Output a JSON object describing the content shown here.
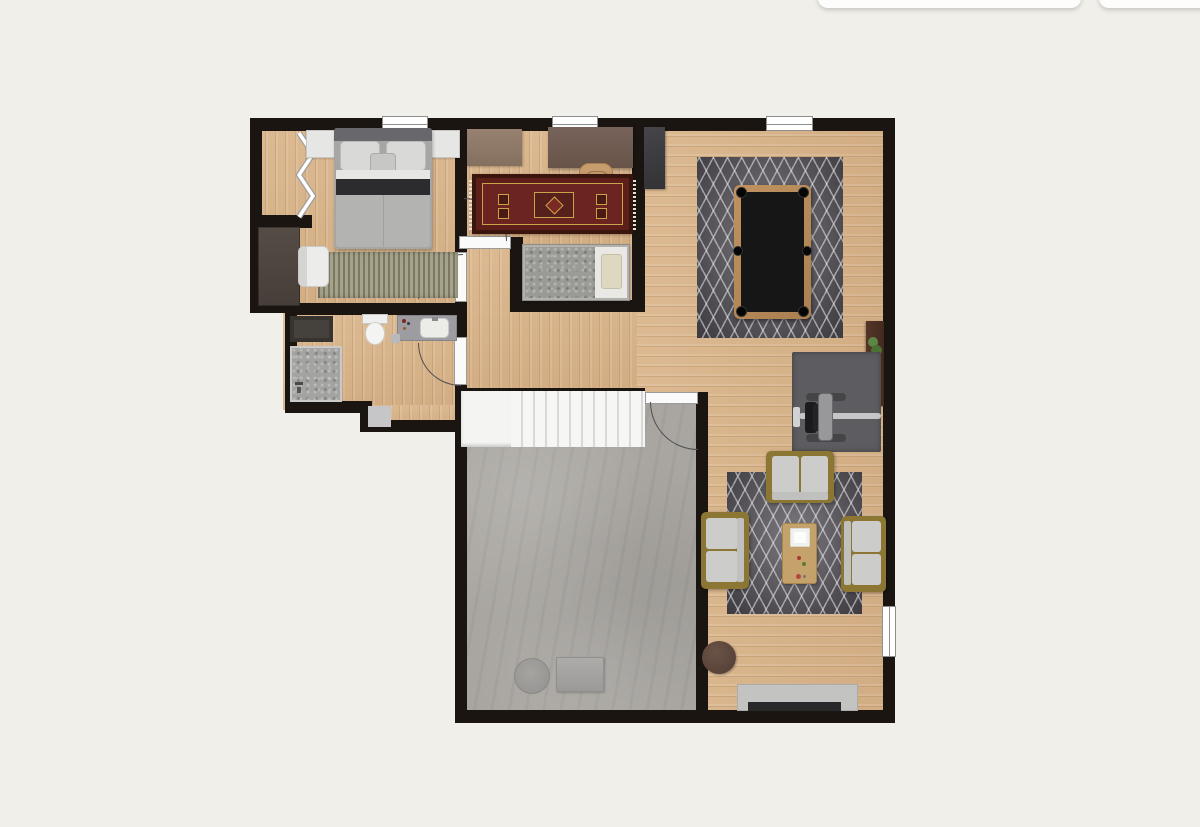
{
  "canvas": {
    "width": 1200,
    "height": 827,
    "background": "#f0efe9"
  },
  "toolbar_fragments": {
    "description": "bottom edges of two white UI cards clipped at top of screenshot",
    "count": 2
  },
  "palette": {
    "page_background": "#f0efe9",
    "wall": "#1a1511",
    "wood_floor": "#d7b289",
    "wood_grain": "#926339",
    "concrete_floor": "#a9a6a1",
    "stairs_white": "#f4f4f2",
    "tread_line": "#d8d8d6",
    "rug_charcoal": "#514f54",
    "rug_lattice_white": "#e8e8ea",
    "oriental_rug_border": "#3a150e",
    "oriental_rug_field": "#5e1f1a",
    "oriental_rug_accent": "#c9a24a",
    "sofa_frame_gold": "#8b7733",
    "sofa_cushion_gray": "#cccccb",
    "pool_table_wood": "#b68a55",
    "pool_table_felt": "#161616",
    "door_jamb_white": "#fafafa",
    "window_white": "#ffffff",
    "dark_wardrobe": "#4a423b",
    "office_desk": "#6f5b4f",
    "office_sideboard": "#8e7767",
    "office_chair_tan": "#c79d6e",
    "slate_cabinet": "#3a3a3c",
    "right_desk_brown": "#472c1f",
    "exercise_mat": "#5d5c60",
    "pouf_brown": "#5c463c",
    "tv_console_gray": "#c3c3c1",
    "tv_black": "#28282a",
    "bed_dark_band": "#2c2c2e",
    "striped_rug_olive": "#9a987e"
  },
  "rooms": [
    {
      "id": "bedroom",
      "floor": "wood"
    },
    {
      "id": "closet",
      "floor": "wood"
    },
    {
      "id": "office-den",
      "floor": "wood"
    },
    {
      "id": "bed-nook",
      "floor": "wood"
    },
    {
      "id": "bathroom",
      "floor": "wood"
    },
    {
      "id": "hallway",
      "floor": "wood"
    },
    {
      "id": "great-room",
      "floor": "wood"
    },
    {
      "id": "garage-utility-room",
      "floor": "concrete"
    }
  ],
  "stairs": {
    "treads": 11,
    "landing": true,
    "location": "top edge of concrete room"
  },
  "doors": {
    "hinged_with_arc": 4,
    "bifold_closet": 1,
    "cased_openings": 1
  },
  "windows": {
    "top_wall": 3,
    "right_wall": 1
  },
  "furniture_inventory": [
    "double-bed",
    "nightstand-left",
    "nightstand-right",
    "striped-rug",
    "armchair-white",
    "wardrobe-dark",
    "bifold-closet-door",
    "office-desk",
    "office-chair",
    "office-sideboard",
    "oriental-rug",
    "slate-cabinet",
    "single-bed",
    "single-bed-pillow",
    "bathroom-dark-cabinet",
    "shower",
    "toilet",
    "sink-vanity",
    "hall-mat",
    "pool-table",
    "pool-table-rug",
    "right-wall-desk",
    "desk-plant",
    "exercise-mat",
    "weight-bench",
    "living-rug",
    "sofa-top",
    "sofa-left",
    "sofa-right",
    "coffee-table",
    "coffee-table-tray",
    "pouf-round",
    "tv-console",
    "tv",
    "round-ottoman",
    "storage-box"
  ],
  "pool_table": {
    "pockets": 6,
    "orientation": "portrait"
  }
}
